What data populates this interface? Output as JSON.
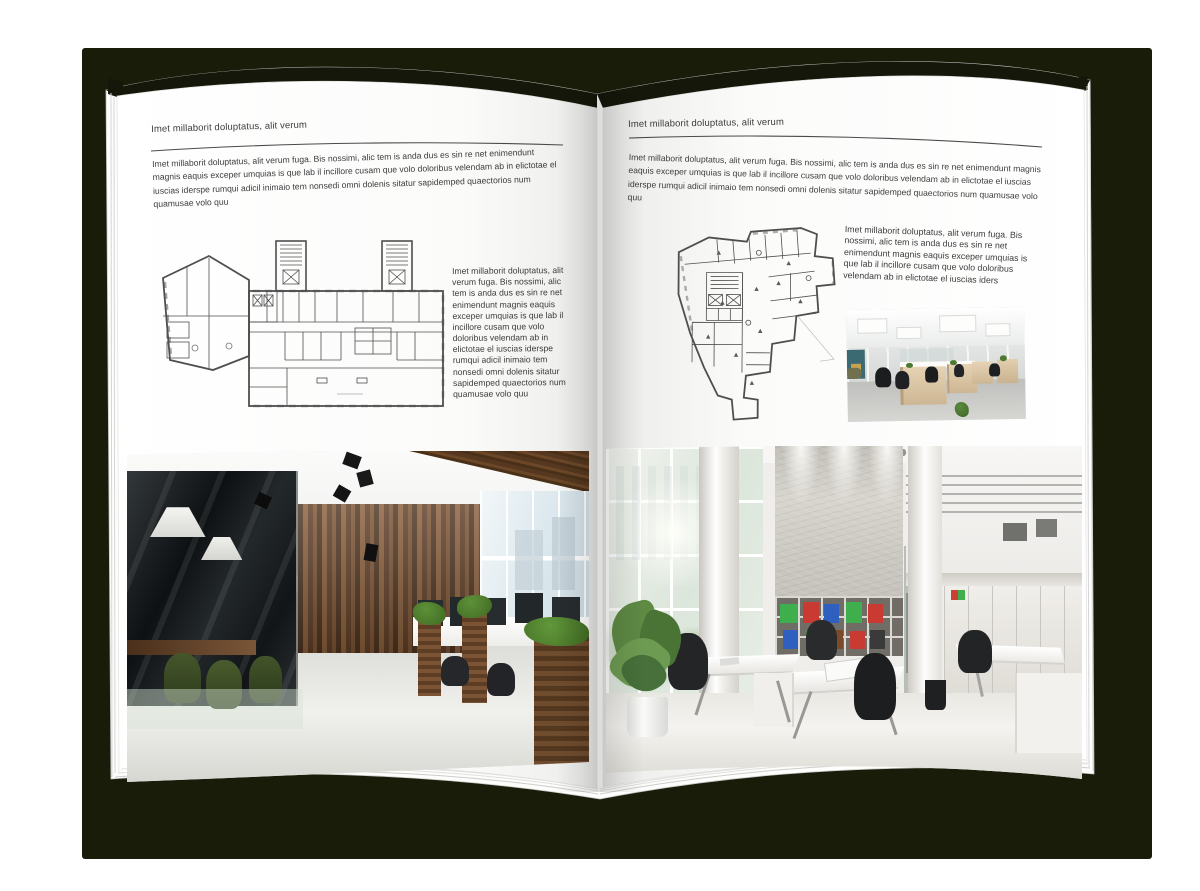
{
  "backdrop_color": "#1a1c0a",
  "left_page": {
    "header": "Imet millaborit doluptatus, alit verum",
    "body": "Imet millaborit doluptatus, alit verum fuga. Bis nossimi, alic tem is anda dus es sin re net enimendunt magnis eaquis exceper umquias is que lab il incillore cusam que volo doloribus velendam ab in elictotae el iuscias iderspe rumqui adicil inimaio tem nonsedi omni dolenis sitatur sapidemped quaectorios num quamusae volo quu",
    "side_text": "Imet millaborit doluptatus, alit verum fuga. Bis nossimi, alic tem is anda dus es sin re net enimendunt magnis eaquis exceper umquias is que lab il incillore cusam que volo doloribus velendam ab in elictotae el iuscias iderspe rumqui adicil inimaio tem nonsedi omni dolenis sitatur sapidemped quaectorios num quamusae volo quu"
  },
  "right_page": {
    "header": "Imet millaborit doluptatus, alit verum",
    "body": "Imet millaborit doluptatus, alit verum fuga. Bis nossimi, alic tem is anda dus es sin re net enimendunt magnis eaquis exceper umquias is que lab il incillore cusam que volo doloribus velendam ab in elictotae el iuscias iderspe rumqui adicil inimaio tem nonsedi omni dolenis sitatur sapidemped quaectorios num quamusae volo quu",
    "side_text": "Imet millaborit doluptatus, alit verum fuga. Bis nossimi, alic tem is anda dus es sin re net enimendunt magnis eaquis exceper umquias is que lab il incillore cusam que volo doloribus velendam ab in elictotae el iuscias iders"
  }
}
